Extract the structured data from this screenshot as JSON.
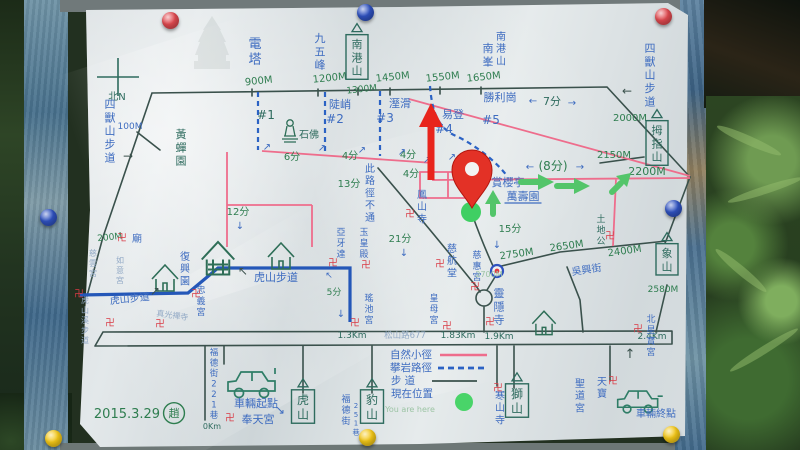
{
  "meta": {
    "date": "2015.3.29",
    "author_seal": "趙",
    "current_position_note": "You are here"
  },
  "legend": {
    "entries": [
      {
        "label": "自然小徑",
        "symbol": "pink-solid-line"
      },
      {
        "label": "攀岩路徑",
        "symbol": "blue-dashed-line"
      },
      {
        "label": "步 道",
        "symbol": "dark-solid-line"
      },
      {
        "label": "現在位置",
        "symbol": "green-dot"
      }
    ]
  },
  "colors": {
    "ink": "#3a514c",
    "blue": "#3e6cc0",
    "teal": "#2e6b5e",
    "green": "#2e7d4f",
    "pink": "#ee6d8c",
    "red": "#d93a44",
    "fblue": "#93aac6",
    "fgreen": "#9cc4a4",
    "board_blue": "#4a7090",
    "paper": "#dde3e5",
    "marker_red": "#e8241c",
    "arrow_green": "#53c56a",
    "trail_blue": "#2457b8",
    "pin_red": "#e04a50",
    "pin_blue": "#2f52c0",
    "pin_yellow": "#f3c718"
  },
  "map": {
    "labels": [
      {
        "t": "北N",
        "x": 117,
        "y": 100,
        "c": "teal",
        "s": 10
      },
      {
        "t": "電塔",
        "x": 255,
        "y": 48,
        "c": "blue",
        "s": 13,
        "v": 1
      },
      {
        "t": "900M",
        "x": 259,
        "y": 84,
        "c": "green",
        "s": 10,
        "a": -6
      },
      {
        "t": "九五峰",
        "x": 320,
        "y": 42,
        "c": "blue",
        "s": 11,
        "v": 1
      },
      {
        "t": "1200M",
        "x": 330,
        "y": 81,
        "c": "green",
        "s": 10,
        "a": -6
      },
      {
        "t": "南港山",
        "x": 357,
        "y": 48,
        "c": "teal",
        "s": 11,
        "v": 1,
        "box": 1
      },
      {
        "t": "1300M",
        "x": 362,
        "y": 92,
        "c": "green",
        "s": 9,
        "a": -6
      },
      {
        "t": "1450M",
        "x": 393,
        "y": 80,
        "c": "green",
        "s": 10,
        "a": -6
      },
      {
        "t": "1550M",
        "x": 443,
        "y": 80,
        "c": "green",
        "s": 10,
        "a": -6
      },
      {
        "t": "1650M",
        "x": 484,
        "y": 80,
        "c": "green",
        "s": 10,
        "a": -6
      },
      {
        "t": "南峯",
        "x": 488,
        "y": 52,
        "c": "blue",
        "s": 11,
        "v": 1
      },
      {
        "t": "南港山",
        "x": 501,
        "y": 40,
        "c": "blue",
        "s": 10,
        "v": 1
      },
      {
        "t": "勝利崗",
        "x": 500,
        "y": 101,
        "c": "blue",
        "s": 11
      },
      {
        "t": "7分",
        "x": 552,
        "y": 105,
        "c": "teal",
        "s": 11
      },
      {
        "t": "#5",
        "x": 491,
        "y": 124,
        "c": "blue",
        "s": 12
      },
      {
        "t": "2000M",
        "x": 630,
        "y": 121,
        "c": "green",
        "s": 10
      },
      {
        "t": "四獸山步道",
        "x": 650,
        "y": 52,
        "c": "blue",
        "s": 11,
        "v": 1
      },
      {
        "t": "四獸山步道",
        "x": 110,
        "y": 108,
        "c": "blue",
        "s": 11,
        "v": 1
      },
      {
        "t": "100M",
        "x": 130,
        "y": 129,
        "c": "blue",
        "s": 9
      },
      {
        "t": "黃蟬園",
        "x": 181,
        "y": 138,
        "c": "teal",
        "s": 11,
        "v": 1
      },
      {
        "t": "陡峭",
        "x": 340,
        "y": 108,
        "c": "blue",
        "s": 11
      },
      {
        "t": "#2",
        "x": 335,
        "y": 123,
        "c": "blue",
        "s": 12
      },
      {
        "t": "#1",
        "x": 266,
        "y": 119,
        "c": "teal",
        "s": 12
      },
      {
        "t": "溼滑",
        "x": 400,
        "y": 107,
        "c": "blue",
        "s": 11
      },
      {
        "t": "#3",
        "x": 385,
        "y": 122,
        "c": "blue",
        "s": 12
      },
      {
        "t": "易登",
        "x": 453,
        "y": 118,
        "c": "blue",
        "s": 11
      },
      {
        "t": "#4",
        "x": 444,
        "y": 133,
        "c": "blue",
        "s": 12
      },
      {
        "t": "石佛",
        "x": 309,
        "y": 138,
        "c": "teal",
        "s": 10
      },
      {
        "t": "6分",
        "x": 292,
        "y": 160,
        "c": "green",
        "s": 10
      },
      {
        "t": "4分",
        "x": 350,
        "y": 159,
        "c": "green",
        "s": 10
      },
      {
        "t": "4分",
        "x": 408,
        "y": 158,
        "c": "green",
        "s": 10
      },
      {
        "t": "4分",
        "x": 411,
        "y": 177,
        "c": "green",
        "s": 10
      },
      {
        "t": "13分",
        "x": 349,
        "y": 187,
        "c": "green",
        "s": 10
      },
      {
        "t": "12分",
        "x": 238,
        "y": 215,
        "c": "green",
        "s": 10
      },
      {
        "t": "此路徑不通",
        "x": 370,
        "y": 172,
        "c": "blue",
        "s": 10,
        "v": 1
      },
      {
        "t": "鳳山寺",
        "x": 422,
        "y": 198,
        "c": "blue",
        "s": 10,
        "v": 1
      },
      {
        "t": "21分",
        "x": 400,
        "y": 242,
        "c": "green",
        "s": 10
      },
      {
        "t": "(8分)",
        "x": 553,
        "y": 170,
        "c": "green",
        "s": 12
      },
      {
        "t": "賞櫻亭",
        "x": 508,
        "y": 186,
        "c": "blue",
        "s": 11
      },
      {
        "t": "萬壽園",
        "x": 523,
        "y": 200,
        "c": "blue",
        "s": 11,
        "u": 1
      },
      {
        "t": "2150M",
        "x": 614,
        "y": 158,
        "c": "green",
        "s": 10
      },
      {
        "t": "拇指山",
        "x": 657,
        "y": 134,
        "c": "teal",
        "s": 11,
        "v": 1,
        "box": 1
      },
      {
        "t": "2200M",
        "x": 647,
        "y": 175,
        "c": "green",
        "s": 11
      },
      {
        "t": "15分",
        "x": 510,
        "y": 232,
        "c": "green",
        "s": 10
      },
      {
        "t": "2750M",
        "x": 517,
        "y": 257,
        "c": "green",
        "s": 10,
        "a": -8
      },
      {
        "t": "2650M",
        "x": 567,
        "y": 249,
        "c": "green",
        "s": 10,
        "a": -8
      },
      {
        "t": "2400M",
        "x": 625,
        "y": 254,
        "c": "green",
        "s": 10,
        "a": -8
      },
      {
        "t": "吳興街",
        "x": 587,
        "y": 273,
        "c": "blue",
        "s": 10,
        "a": -8
      },
      {
        "t": "土地公",
        "x": 601,
        "y": 222,
        "c": "teal",
        "s": 9,
        "v": 1
      },
      {
        "t": "象山",
        "x": 667,
        "y": 257,
        "c": "teal",
        "s": 11,
        "v": 1,
        "box": 1
      },
      {
        "t": "2580M",
        "x": 663,
        "y": 292,
        "c": "green",
        "s": 9
      },
      {
        "t": "慈航堂",
        "x": 452,
        "y": 252,
        "c": "blue",
        "s": 10,
        "v": 1
      },
      {
        "t": "慈惠宮",
        "x": 477,
        "y": 258,
        "c": "blue",
        "s": 9,
        "v": 1
      },
      {
        "t": "2700M",
        "x": 489,
        "y": 277,
        "c": "fgreen",
        "s": 8
      },
      {
        "t": "皇母宮",
        "x": 434,
        "y": 301,
        "c": "blue",
        "s": 9,
        "v": 1
      },
      {
        "t": "靈隱寺",
        "x": 499,
        "y": 297,
        "c": "blue",
        "s": 11,
        "v": 1
      },
      {
        "t": "松山路677",
        "x": 405,
        "y": 338,
        "c": "fblue",
        "s": 8.5
      },
      {
        "t": "1.3Km",
        "x": 352,
        "y": 338,
        "c": "teal",
        "s": 9
      },
      {
        "t": "1.83Km",
        "x": 458,
        "y": 338,
        "c": "teal",
        "s": 9
      },
      {
        "t": "1.9Km",
        "x": 499,
        "y": 339,
        "c": "teal",
        "s": 9
      },
      {
        "t": "2.4Km",
        "x": 652,
        "y": 339,
        "c": "teal",
        "s": 9
      },
      {
        "t": "0Km",
        "x": 212,
        "y": 429,
        "c": "teal",
        "s": 8
      },
      {
        "t": "福德街221巷",
        "x": 214,
        "y": 355,
        "c": "blue",
        "s": 8.5,
        "v": 1
      },
      {
        "t": "車輛起點",
        "x": 256,
        "y": 407,
        "c": "blue",
        "s": 11
      },
      {
        "t": "奉天宮",
        "x": 258,
        "y": 423,
        "c": "blue",
        "s": 11
      },
      {
        "t": "虎山",
        "x": 303,
        "y": 404,
        "c": "teal",
        "s": 12,
        "v": 1,
        "box": 1
      },
      {
        "t": "福德街",
        "x": 346,
        "y": 402,
        "c": "blue",
        "s": 9,
        "v": 1
      },
      {
        "t": "251巷",
        "x": 356,
        "y": 408,
        "c": "blue",
        "s": 7,
        "v": 1
      },
      {
        "t": "豹山",
        "x": 372,
        "y": 404,
        "c": "teal",
        "s": 12,
        "v": 1,
        "box": 1
      },
      {
        "t": "獅山",
        "x": 517,
        "y": 398,
        "c": "teal",
        "s": 12,
        "v": 1,
        "box": 1
      },
      {
        "t": "寒山寺",
        "x": 500,
        "y": 399,
        "c": "blue",
        "s": 10,
        "v": 1
      },
      {
        "t": "聖道宮",
        "x": 580,
        "y": 387,
        "c": "blue",
        "s": 10,
        "v": 1
      },
      {
        "t": "天寶",
        "x": 602,
        "y": 385,
        "c": "blue",
        "s": 10,
        "v": 1
      },
      {
        "t": "北星寶宮",
        "x": 651,
        "y": 322,
        "c": "blue",
        "s": 9,
        "v": 1
      },
      {
        "t": "車輛終點",
        "x": 656,
        "y": 417,
        "c": "blue",
        "s": 10
      },
      {
        "t": "2015.3.29",
        "x": 127,
        "y": 418,
        "c": "green",
        "s": 13
      },
      {
        "t": "趙",
        "x": 174,
        "y": 417,
        "c": "green",
        "s": 11,
        "circ": 1
      },
      {
        "t": "自然小徑",
        "x": 411,
        "y": 358,
        "c": "blue",
        "s": 10.5
      },
      {
        "t": "攀岩路徑",
        "x": 411,
        "y": 371,
        "c": "blue",
        "s": 10.5
      },
      {
        "t": "步 道",
        "x": 403,
        "y": 384,
        "c": "blue",
        "s": 10.5
      },
      {
        "t": "現在位置",
        "x": 412,
        "y": 397,
        "c": "blue",
        "s": 10.5
      },
      {
        "t": "You are here",
        "x": 410,
        "y": 412,
        "c": "fgreen",
        "s": 8
      },
      {
        "t": "虎山步道",
        "x": 130,
        "y": 302,
        "c": "blue",
        "s": 10,
        "a": -6
      },
      {
        "t": "虎山步道",
        "x": 276,
        "y": 281,
        "c": "blue",
        "s": 11
      },
      {
        "t": "復興園",
        "x": 185,
        "y": 260,
        "c": "blue",
        "s": 10,
        "v": 1
      },
      {
        "t": "忠義宮",
        "x": 201,
        "y": 293,
        "c": "blue",
        "s": 9,
        "v": 1
      },
      {
        "t": "瑤池宮",
        "x": 369,
        "y": 301,
        "c": "blue",
        "s": 9,
        "v": 1
      },
      {
        "t": "5分",
        "x": 334,
        "y": 295,
        "c": "green",
        "s": 9
      },
      {
        "t": "200M",
        "x": 110,
        "y": 240,
        "c": "green",
        "s": 9,
        "a": -6
      },
      {
        "t": "廟",
        "x": 137,
        "y": 242,
        "c": "blue",
        "s": 10
      },
      {
        "t": "如意宮",
        "x": 120,
        "y": 263,
        "c": "fblue",
        "s": 8,
        "v": 1
      },
      {
        "t": "慈雲宮",
        "x": 93,
        "y": 256,
        "c": "fblue",
        "s": 8,
        "v": 1
      },
      {
        "t": "真光禪寺",
        "x": 172,
        "y": 318,
        "c": "fblue",
        "s": 8,
        "a": 8
      },
      {
        "t": "虎山溪步道",
        "x": 85,
        "y": 303,
        "c": "fblue",
        "s": 8,
        "v": 1
      },
      {
        "t": "玉皇殿",
        "x": 364,
        "y": 235,
        "c": "blue",
        "s": 9,
        "v": 1
      },
      {
        "t": "亞牙達",
        "x": 341,
        "y": 235,
        "c": "blue",
        "s": 9,
        "v": 1
      }
    ],
    "arrows": [
      {
        "g": "↗",
        "x": 267,
        "y": 150,
        "c": "blue",
        "s": 10
      },
      {
        "g": "↗",
        "x": 322,
        "y": 151,
        "c": "blue",
        "s": 10
      },
      {
        "g": "↗",
        "x": 362,
        "y": 153,
        "c": "blue",
        "s": 10
      },
      {
        "g": "↗",
        "x": 402,
        "y": 155,
        "c": "blue",
        "s": 10
      },
      {
        "g": "↗",
        "x": 427,
        "y": 163,
        "c": "blue",
        "s": 10
      },
      {
        "g": "↗",
        "x": 452,
        "y": 160,
        "c": "blue",
        "s": 10
      },
      {
        "g": "←",
        "x": 533,
        "y": 104,
        "c": "blue",
        "s": 10
      },
      {
        "g": "→",
        "x": 572,
        "y": 106,
        "c": "blue",
        "s": 10
      },
      {
        "g": "←",
        "x": 530,
        "y": 170,
        "c": "blue",
        "s": 10
      },
      {
        "g": "→",
        "x": 580,
        "y": 170,
        "c": "blue",
        "s": 10
      },
      {
        "g": "↓",
        "x": 497,
        "y": 248,
        "c": "blue",
        "s": 10
      },
      {
        "g": "↓",
        "x": 404,
        "y": 256,
        "c": "blue",
        "s": 10
      },
      {
        "g": "↓",
        "x": 240,
        "y": 229,
        "c": "blue",
        "s": 10
      },
      {
        "g": "↓",
        "x": 341,
        "y": 317,
        "c": "blue",
        "s": 10
      },
      {
        "g": "↖",
        "x": 329,
        "y": 278,
        "c": "blue",
        "s": 9
      },
      {
        "g": "→",
        "x": 128,
        "y": 160,
        "c": "ink",
        "s": 12
      },
      {
        "g": "←",
        "x": 627,
        "y": 95,
        "c": "ink",
        "s": 12
      },
      {
        "g": "↗",
        "x": 155,
        "y": 295,
        "c": "ink",
        "s": 12
      },
      {
        "g": "↖",
        "x": 243,
        "y": 275,
        "c": "ink",
        "s": 12
      },
      {
        "g": "↘",
        "x": 280,
        "y": 414,
        "c": "blue",
        "s": 12
      },
      {
        "g": "↑",
        "x": 630,
        "y": 358,
        "c": "ink",
        "s": 13
      }
    ],
    "temple_marks": [
      [
        122,
        241
      ],
      [
        79,
        297
      ],
      [
        160,
        327
      ],
      [
        110,
        326
      ],
      [
        196,
        297
      ],
      [
        230,
        421
      ],
      [
        333,
        266
      ],
      [
        366,
        268
      ],
      [
        355,
        326
      ],
      [
        410,
        217
      ],
      [
        440,
        267
      ],
      [
        475,
        290
      ],
      [
        490,
        325
      ],
      [
        447,
        329
      ],
      [
        610,
        239
      ],
      [
        638,
        332
      ],
      [
        613,
        384
      ],
      [
        498,
        391
      ]
    ],
    "temple_mark_glyph": "卍",
    "pushpins": [
      {
        "color": "red",
        "x": 170,
        "y": 20
      },
      {
        "color": "blue",
        "x": 365,
        "y": 12
      },
      {
        "color": "red",
        "x": 663,
        "y": 16
      },
      {
        "color": "blue",
        "x": 48,
        "y": 217
      },
      {
        "color": "blue",
        "x": 673,
        "y": 208
      },
      {
        "color": "yellow",
        "x": 53,
        "y": 438
      },
      {
        "color": "yellow",
        "x": 367,
        "y": 437
      },
      {
        "color": "yellow",
        "x": 671,
        "y": 434
      }
    ]
  }
}
